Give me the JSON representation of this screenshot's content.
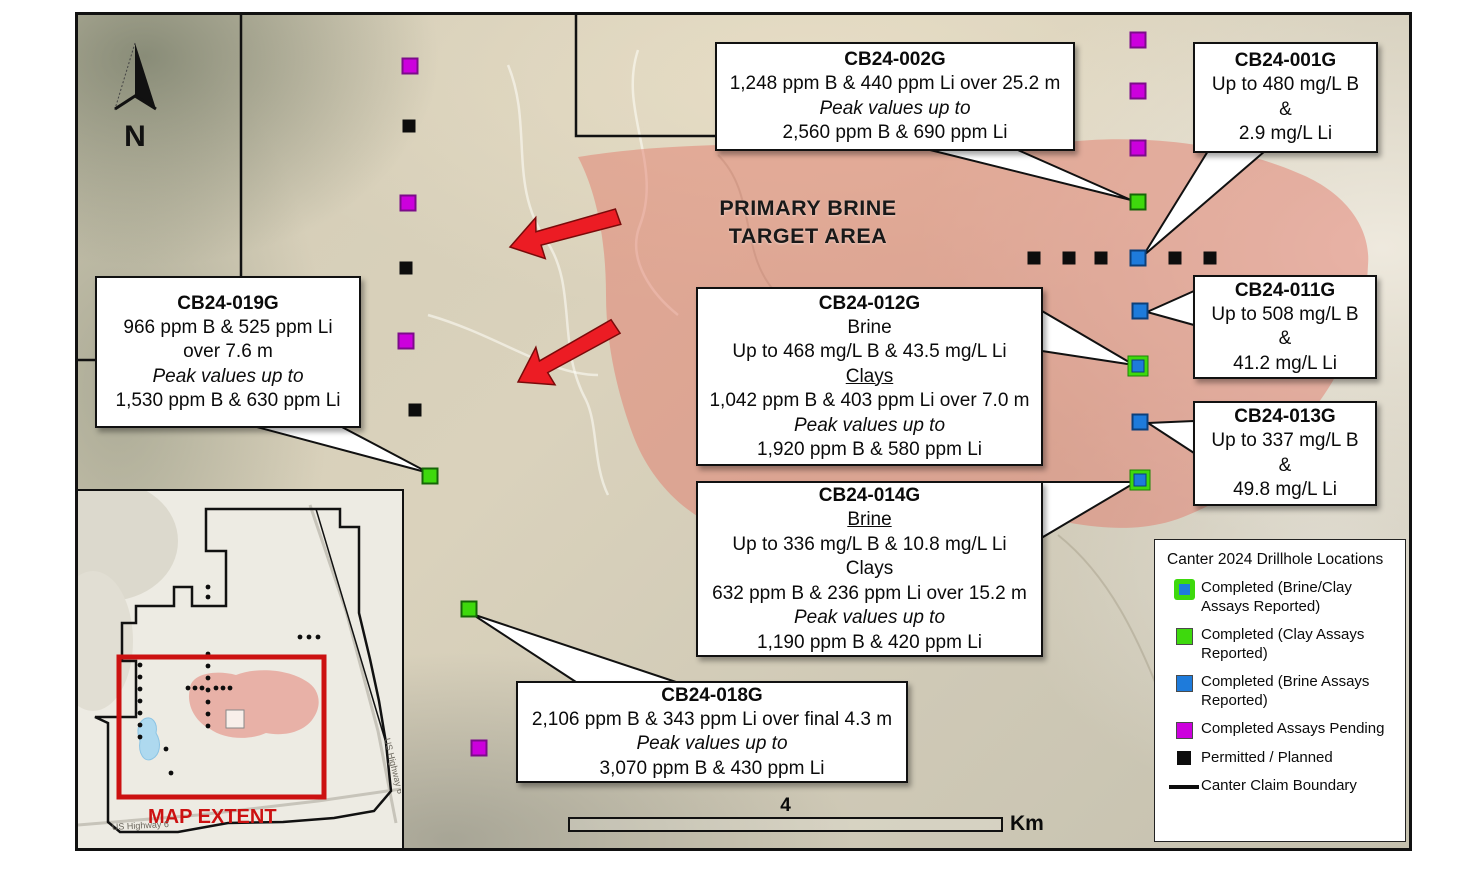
{
  "figure": {
    "north_label": "N",
    "target_area_label_line1": "PRIMARY BRINE",
    "target_area_label_line2": "TARGET AREA",
    "scale_bar": {
      "distance": "4",
      "unit": "Km"
    }
  },
  "callouts": {
    "cb002": {
      "title": "CB24-002G",
      "line1": "1,248 ppm B & 440 ppm Li over 25.2 m",
      "line2": "Peak values up to",
      "line3": "2,560 ppm B & 690 ppm Li"
    },
    "cb001": {
      "title": "CB24-001G",
      "line1": "Up to 480 mg/L B",
      "line2": "&",
      "line3": "2.9 mg/L Li"
    },
    "cb019": {
      "title": "CB24-019G",
      "line1": "966 ppm B & 525 ppm Li",
      "line2": "over 7.6 m",
      "line3": "Peak values up to",
      "line4": "1,530 ppm B & 630 ppm Li"
    },
    "cb012": {
      "title": "CB24-012G",
      "line1": "Brine",
      "line2": "Up to 468 mg/L B & 43.5 mg/L Li",
      "line3": "Clays",
      "line4": "1,042 ppm B & 403 ppm Li over 7.0 m",
      "line5": "Peak values up to",
      "line6": "1,920 ppm B & 580 ppm Li"
    },
    "cb011": {
      "title": "CB24-011G",
      "line1": "Up to 508 mg/L B",
      "line2": "&",
      "line3": "41.2 mg/L Li"
    },
    "cb013": {
      "title": "CB24-013G",
      "line1": "Up to 337 mg/L B",
      "line2": "&",
      "line3": "49.8 mg/L Li"
    },
    "cb014": {
      "title": "CB24-014G",
      "line1": "Brine",
      "line2": "Up to 336 mg/L B & 10.8 mg/L Li",
      "line3": "Clays",
      "line4": "632 ppm B & 236 ppm Li over 15.2 m",
      "line5": "Peak values up to",
      "line6": "1,190 ppm B & 420 ppm Li"
    },
    "cb018": {
      "title": "CB24-018G",
      "line1": "2,106 ppm B & 343 ppm Li over final 4.3 m",
      "line2": "Peak values up to",
      "line3": "3,070 ppm B & 430 ppm Li"
    }
  },
  "legend": {
    "title": "Canter 2024 Drillhole Locations",
    "items": [
      {
        "label": "Completed (Brine/Clay Assays Reported)"
      },
      {
        "label": "Completed (Clay Assays Reported)"
      },
      {
        "label": "Completed (Brine Assays Reported)"
      },
      {
        "label": "Completed Assays Pending"
      },
      {
        "label": "Permitted / Planned"
      },
      {
        "label": "Canter Claim Boundary"
      }
    ]
  },
  "inset": {
    "extent_label": "MAP EXTENT",
    "road_label_bottom": "US Highway 6",
    "road_label_right": "US Highway 6"
  },
  "colors": {
    "brine_clay_green": "#3ed90d",
    "brine_blue": "#1e7bdb",
    "assays_pending_magenta": "#cc00dd",
    "permitted_black": "#0d0d0d",
    "target_area_pink": "#e07868",
    "arrow_red": "#ec1c24",
    "map_extent_red": "#cc1111"
  }
}
